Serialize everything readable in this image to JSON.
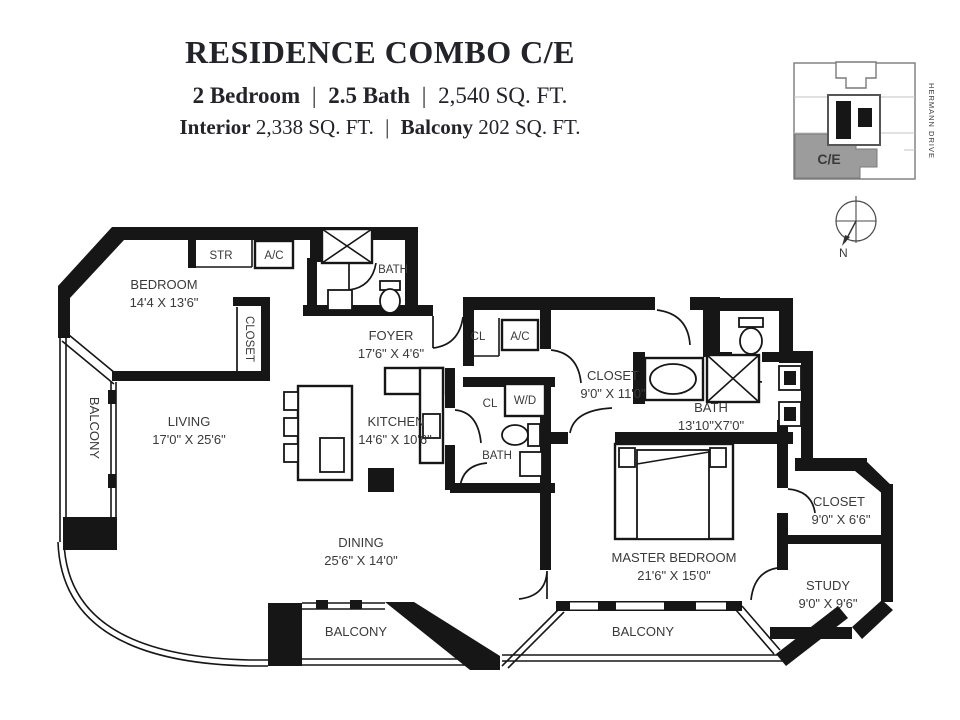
{
  "header": {
    "title": "RESIDENCE COMBO C/E",
    "specs": {
      "bedrooms": "2 Bedroom",
      "sep1": "|",
      "baths": "2.5 Bath",
      "sep2": "|",
      "total_area": "2,540 SQ. FT."
    },
    "areas": {
      "interior_label": "Interior",
      "interior_value": "2,338 SQ. FT.",
      "sep": "|",
      "balcony_label": "Balcony",
      "balcony_value": "202 SQ. FT."
    }
  },
  "keyplan": {
    "unit": "C/E",
    "street": "HERMANN DRIVE",
    "compass": "N",
    "highlight_color": "#9c9c9c"
  },
  "rooms": {
    "bedroom": {
      "name": "BEDROOM",
      "dims": "14'4 X 13'6\""
    },
    "bedroom_closet": {
      "name": "CLOSET"
    },
    "str": {
      "name": "STR"
    },
    "ac1": {
      "name": "A/C"
    },
    "bath1": {
      "name": "BATH"
    },
    "foyer": {
      "name": "FOYER",
      "dims": "17'6\" X 4'6\""
    },
    "cl1": {
      "name": "CL"
    },
    "ac2": {
      "name": "A/C"
    },
    "living": {
      "name": "LIVING",
      "dims": "17'0\" X 25'6\""
    },
    "kitchen": {
      "name": "KITCHEN",
      "dims": "14'6\" X 10'6\""
    },
    "cl2": {
      "name": "CL"
    },
    "wd": {
      "name": "W/D"
    },
    "bath2": {
      "name": "BATH"
    },
    "walkin_closet": {
      "name": "CLOSET",
      "dims": "9'0\" X 11'0\""
    },
    "master_bath": {
      "name": "BATH",
      "dims": "13'10\"X7'0\""
    },
    "dining": {
      "name": "DINING",
      "dims": "25'6\" X 14'0\""
    },
    "master_bedroom": {
      "name": "MASTER BEDROOM",
      "dims": "21'6\" X 15'0\""
    },
    "master_closet": {
      "name": "CLOSET",
      "dims": "9'0\" X 6'6\""
    },
    "study": {
      "name": "STUDY",
      "dims": "9'0\" X 9'6\""
    },
    "balcony_left": {
      "name": "BALCONY"
    },
    "balcony_bl": {
      "name": "BALCONY"
    },
    "balcony_br": {
      "name": "BALCONY"
    }
  }
}
